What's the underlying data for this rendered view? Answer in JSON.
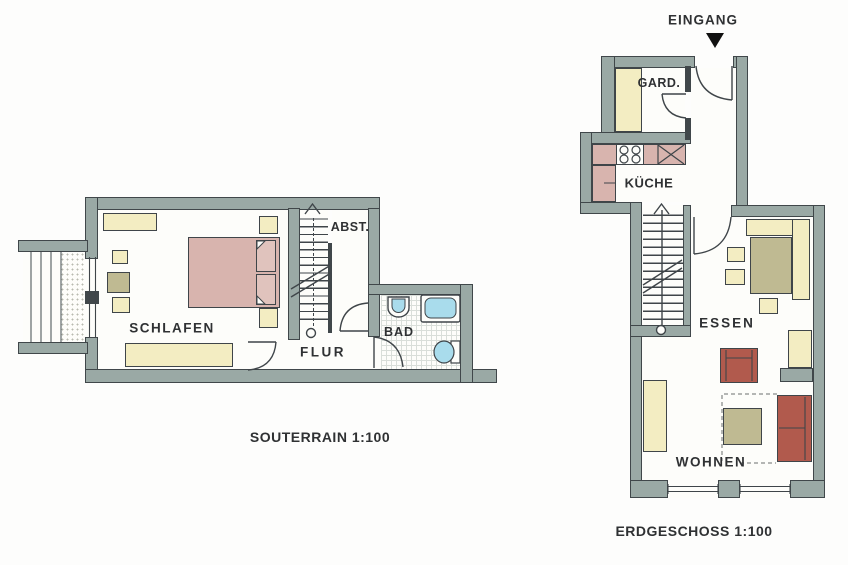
{
  "plans": {
    "souterrain": {
      "caption": "SOUTERRAIN 1:100",
      "rooms": {
        "schlafen": "SCHLAFEN",
        "flur": "FLUR",
        "abst": "ABST.",
        "bad": "BAD"
      }
    },
    "erdgeschoss": {
      "caption": "ERDGESCHOSS 1:100",
      "entrance": "EINGANG",
      "rooms": {
        "gard": "GARD.",
        "kueche": "KÜCHE",
        "essen": "ESSEN",
        "wohnen": "WOHNEN"
      }
    }
  },
  "colors": {
    "wall_fill": "#9aa9a5",
    "wall_outline": "#40474a",
    "floor": "#fdfdfa",
    "furniture_cream": "#f3edc2",
    "furniture_pink": "#d8b4ae",
    "furniture_khaki": "#bfba92",
    "furniture_red": "#b15a4d",
    "fixture_blue": "#a9dcec",
    "entrance_marker": "#111111"
  }
}
